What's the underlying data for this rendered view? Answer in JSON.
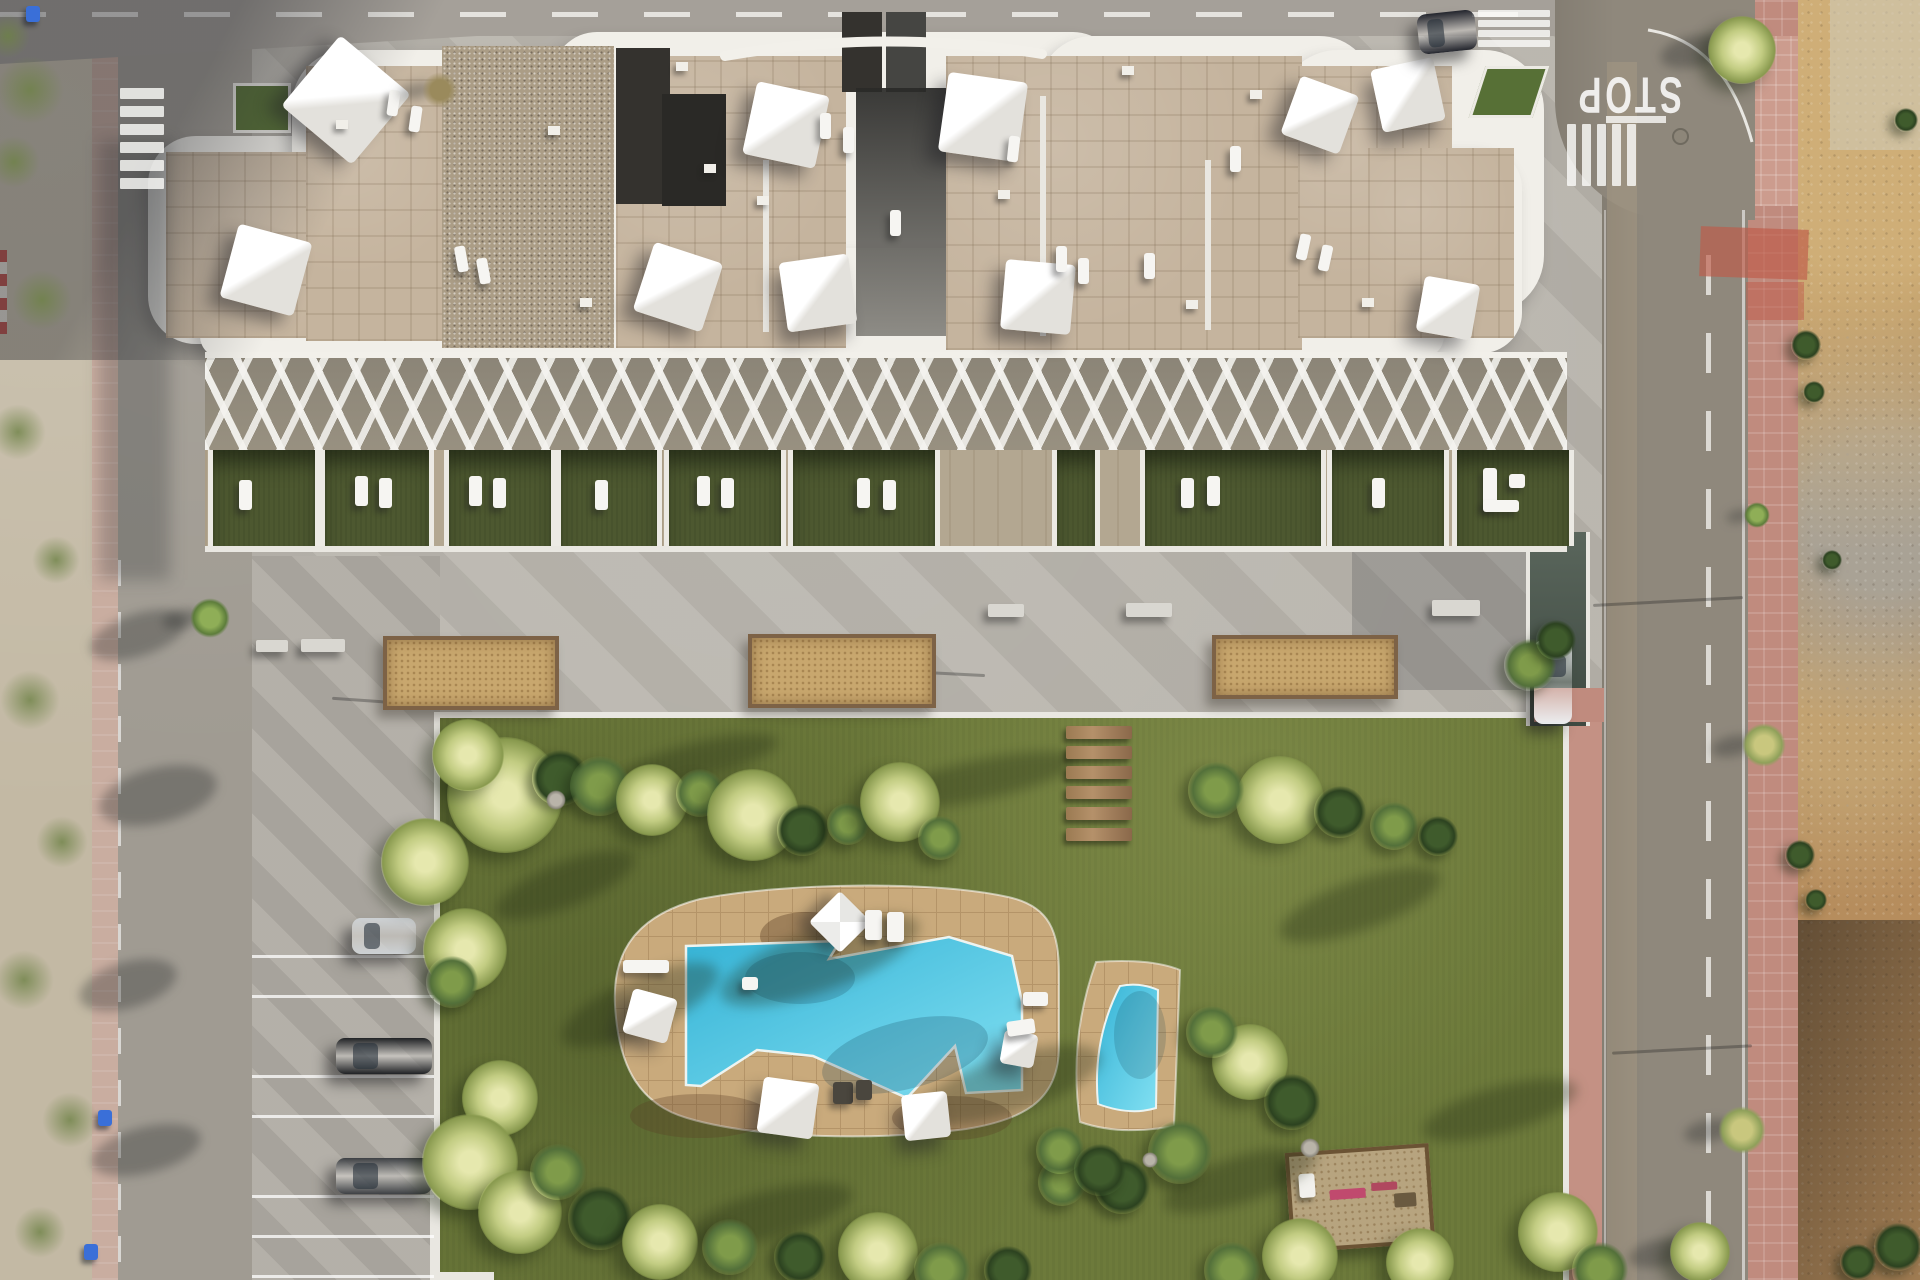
{
  "meta": {
    "description": "Aerial top-down 3D render of a white residential apartment complex with rooftop terraces and shade sails, communal lawn garden, free-form swimming pool with small plunge pool, concrete plaza with planters, street parking, roads with STOP marking and crosswalks, and an undeveloped dirt lot on the right"
  },
  "labels": {
    "stop": "STOP"
  },
  "palette": {
    "asphalt_left": "#a09b92",
    "asphalt_right": "#8f887c",
    "sidewalk_pink": "#c08b7e",
    "dirt": "#b68d5d",
    "lawn": "#6d7a3b",
    "concrete": "#b7b3ab",
    "pool_deck": "#c9aa7c",
    "pool_water": "#35b3d6",
    "stone_roof": "#c5b49e",
    "gravel_roof": "#ab9d86",
    "terrace_grass": "#4d5830",
    "building_white": "#f1efe9"
  },
  "building_sails": [
    [
      346,
      100,
      92,
      40
    ],
    [
      266,
      270,
      76,
      15
    ],
    [
      786,
      125,
      74,
      12
    ],
    [
      983,
      117,
      80,
      8
    ],
    [
      678,
      287,
      72,
      18
    ],
    [
      818,
      293,
      70,
      -8
    ],
    [
      1038,
      297,
      70,
      5
    ],
    [
      1320,
      115,
      62,
      20
    ],
    [
      1408,
      95,
      64,
      -12
    ],
    [
      1448,
      308,
      56,
      10
    ]
  ],
  "roof_loungers": [
    [
      388,
      90,
      8
    ],
    [
      410,
      106,
      8
    ],
    [
      820,
      113,
      0
    ],
    [
      843,
      127,
      0
    ],
    [
      1056,
      246,
      0
    ],
    [
      1078,
      258,
      0
    ],
    [
      1144,
      253,
      0
    ],
    [
      456,
      246,
      -10
    ],
    [
      478,
      258,
      -10
    ],
    [
      1298,
      234,
      12
    ],
    [
      1320,
      245,
      12
    ],
    [
      890,
      210,
      0
    ],
    [
      1230,
      146,
      0
    ],
    [
      1008,
      136,
      6
    ]
  ],
  "vents": [
    [
      548,
      126
    ],
    [
      676,
      62
    ],
    [
      704,
      164
    ],
    [
      757,
      196
    ],
    [
      1122,
      66
    ],
    [
      1250,
      90
    ],
    [
      580,
      298
    ],
    [
      1186,
      300
    ],
    [
      1362,
      298
    ],
    [
      998,
      190
    ],
    [
      336,
      120
    ]
  ],
  "terrace_cells": [
    {
      "x": 208,
      "w": 102,
      "l": [
        [
          26,
          30
        ]
      ]
    },
    {
      "x": 320,
      "w": 104,
      "l": [
        [
          30,
          26
        ],
        [
          54,
          28
        ]
      ]
    },
    {
      "x": 444,
      "w": 102,
      "l": [
        [
          20,
          26
        ],
        [
          44,
          28
        ]
      ]
    },
    {
      "x": 556,
      "w": 96,
      "l": [
        [
          34,
          30
        ]
      ]
    },
    {
      "x": 664,
      "w": 112,
      "l": [
        [
          28,
          26
        ],
        [
          52,
          28
        ]
      ]
    },
    {
      "x": 788,
      "w": 142,
      "l": [
        [
          64,
          28
        ],
        [
          90,
          30
        ]
      ]
    },
    {
      "x": 1052,
      "w": 38,
      "l": []
    },
    {
      "x": 1140,
      "w": 176,
      "l": [
        [
          36,
          28
        ],
        [
          62,
          26
        ]
      ]
    },
    {
      "x": 1327,
      "w": 112,
      "l": [
        [
          40,
          28
        ]
      ]
    },
    {
      "x": 1452,
      "w": 112,
      "sofa": true,
      "l": []
    }
  ],
  "planters": [
    [
      383,
      636,
      168,
      66
    ],
    [
      748,
      634,
      180,
      66
    ],
    [
      1212,
      635,
      178,
      56
    ]
  ],
  "benches": [
    [
      256,
      640,
      32,
      12
    ],
    [
      301,
      639,
      44,
      13
    ],
    [
      988,
      604,
      36,
      13
    ],
    [
      1126,
      603,
      46,
      14
    ],
    [
      1432,
      600,
      48,
      16
    ]
  ],
  "steps": {
    "x": 1066,
    "w": 66,
    "h": 13,
    "ys": [
      726,
      746,
      766,
      786,
      807,
      828
    ]
  },
  "parking": {
    "lines_y": [
      955,
      995,
      1075,
      1115,
      1195,
      1235,
      1275
    ],
    "cars": [
      {
        "x": 352,
        "y": 918,
        "w": 64,
        "h": 36,
        "c": "#cdd1d4"
      },
      {
        "x": 336,
        "y": 1038,
        "w": 96,
        "h": 36,
        "c": "#202225"
      },
      {
        "x": 336,
        "y": 1158,
        "w": 96,
        "h": 36,
        "c": "#3e4145"
      }
    ]
  },
  "street_cars": [
    {
      "x": 1418,
      "y": 12,
      "w": 58,
      "h": 40,
      "c": "#23252d",
      "rot": -6
    },
    {
      "x": 1534,
      "y": 640,
      "w": 38,
      "h": 84,
      "c": "#eceef0",
      "rot": 0
    }
  ],
  "crosswalks": [
    {
      "x": 120,
      "y": 88,
      "w": 44,
      "h": 11,
      "count": 6,
      "dx": 0,
      "dy": 18
    },
    {
      "x": 1567,
      "y": 124,
      "w": 9,
      "h": 62,
      "count": 5,
      "dx": 15,
      "dy": 0
    },
    {
      "x": 1478,
      "y": 10,
      "w": 72,
      "h": 7,
      "count": 4,
      "dx": 0,
      "dy": 10
    }
  ],
  "lawn_shadows": [
    [
      640,
      1005,
      170,
      54,
      -24
    ],
    [
      820,
      960,
      210,
      62,
      -20
    ],
    [
      1010,
      1085,
      190,
      58,
      -18
    ],
    [
      770,
      1215,
      170,
      48,
      -15
    ],
    [
      1360,
      905,
      170,
      50,
      -20
    ],
    [
      1500,
      1110,
      160,
      46,
      -16
    ],
    [
      565,
      885,
      150,
      44,
      -22
    ],
    [
      1240,
      1180,
      160,
      46,
      -18
    ],
    [
      980,
      780,
      200,
      40,
      -12
    ],
    [
      700,
      760,
      160,
      36,
      -14
    ]
  ],
  "road_shadows": [
    [
      138,
      635,
      100,
      42,
      -18
    ],
    [
      158,
      795,
      120,
      55,
      -14
    ],
    [
      128,
      985,
      100,
      46,
      -16
    ],
    [
      146,
      1150,
      112,
      46,
      -14
    ]
  ],
  "pole_shadows": [
    [
      905,
      672,
      80,
      3
    ],
    [
      1228,
      658,
      122,
      2
    ],
    [
      332,
      700,
      92,
      4
    ],
    [
      1352,
      524,
      82,
      2
    ],
    [
      1593,
      600,
      150,
      -3
    ],
    [
      1612,
      1048,
      140,
      -3
    ]
  ],
  "roadside_trees": [
    {
      "x": 1757,
      "y": 515,
      "r": 13,
      "k": "tree"
    },
    {
      "x": 1764,
      "y": 745,
      "r": 22,
      "k": "treeY"
    },
    {
      "x": 1742,
      "y": 1130,
      "r": 24,
      "k": "treeY"
    },
    {
      "x": 1742,
      "y": 50,
      "r": 34,
      "k": "palm"
    },
    {
      "x": 210,
      "y": 618,
      "r": 20,
      "k": "tree"
    },
    {
      "x": 440,
      "y": 90,
      "r": 18,
      "k": "dry"
    },
    {
      "x": 1700,
      "y": 1252,
      "r": 30,
      "k": "palm"
    }
  ],
  "dirt_shrubs": [
    [
      1806,
      345,
      15
    ],
    [
      1814,
      392,
      11
    ],
    [
      1800,
      855,
      15
    ],
    [
      1816,
      900,
      11
    ],
    [
      1898,
      1247,
      24
    ],
    [
      1858,
      1262,
      18
    ],
    [
      1906,
      120,
      12
    ],
    [
      1832,
      560,
      10
    ]
  ],
  "scrub_patches": [
    [
      30,
      90,
      34
    ],
    [
      14,
      162,
      26
    ],
    [
      42,
      300,
      30
    ],
    [
      18,
      432,
      28
    ],
    [
      56,
      560,
      24
    ],
    [
      30,
      700,
      30
    ],
    [
      62,
      842,
      26
    ],
    [
      24,
      980,
      30
    ],
    [
      70,
      1120,
      28
    ],
    [
      40,
      1232,
      26
    ],
    [
      8,
      36,
      22
    ]
  ],
  "bins": [
    [
      26,
      6
    ],
    [
      98,
      1110
    ],
    [
      84,
      1244
    ]
  ],
  "vegetation": [
    [
      505,
      795,
      58,
      "palm"
    ],
    [
      468,
      755,
      36,
      "palm"
    ],
    [
      560,
      778,
      28,
      "dark"
    ],
    [
      600,
      786,
      30,
      "bush"
    ],
    [
      652,
      800,
      36,
      "palm"
    ],
    [
      700,
      793,
      24,
      "bush"
    ],
    [
      753,
      815,
      46,
      "palm"
    ],
    [
      803,
      830,
      26,
      "dark"
    ],
    [
      848,
      824,
      21,
      "bush"
    ],
    [
      900,
      802,
      40,
      "palm"
    ],
    [
      940,
      838,
      22,
      "bush"
    ],
    [
      425,
      862,
      44,
      "palm"
    ],
    [
      465,
      950,
      42,
      "palm"
    ],
    [
      452,
      982,
      26,
      "bush"
    ],
    [
      500,
      1098,
      38,
      "palm"
    ],
    [
      470,
      1162,
      48,
      "palm"
    ],
    [
      520,
      1212,
      42,
      "palm"
    ],
    [
      558,
      1172,
      28,
      "bush"
    ],
    [
      600,
      1218,
      32,
      "dark"
    ],
    [
      660,
      1242,
      38,
      "palm"
    ],
    [
      730,
      1247,
      28,
      "bush"
    ],
    [
      800,
      1257,
      26,
      "dark"
    ],
    [
      878,
      1252,
      40,
      "palm"
    ],
    [
      942,
      1270,
      28,
      "bush"
    ],
    [
      1008,
      1270,
      24,
      "dark"
    ],
    [
      1250,
      1062,
      38,
      "palm"
    ],
    [
      1212,
      1032,
      26,
      "bush"
    ],
    [
      1292,
      1102,
      28,
      "dark"
    ],
    [
      1180,
      1152,
      32,
      "bush"
    ],
    [
      1122,
      1186,
      28,
      "dark"
    ],
    [
      1062,
      1182,
      24,
      "bush"
    ],
    [
      1300,
      1256,
      38,
      "palm"
    ],
    [
      1232,
      1270,
      28,
      "bush"
    ],
    [
      1420,
      1262,
      34,
      "palm"
    ],
    [
      1558,
      1232,
      40,
      "palm"
    ],
    [
      1600,
      1270,
      28,
      "bush"
    ],
    [
      1280,
      800,
      44,
      "palm"
    ],
    [
      1216,
      790,
      28,
      "bush"
    ],
    [
      1340,
      812,
      26,
      "dark"
    ],
    [
      1394,
      826,
      24,
      "bush"
    ],
    [
      1438,
      836,
      20,
      "dark"
    ],
    [
      1530,
      665,
      26,
      "bush"
    ],
    [
      1556,
      640,
      20,
      "dark"
    ],
    [
      1060,
      1150,
      24,
      "bush"
    ],
    [
      1100,
      1170,
      26,
      "dark"
    ],
    [
      556,
      800,
      10,
      "rock"
    ],
    [
      1310,
      1148,
      10,
      "rock"
    ],
    [
      1150,
      1160,
      8,
      "rock"
    ]
  ],
  "pool_furniture": {
    "umbrella": [
      840,
      922,
      44
    ],
    "sails": [
      [
        650,
        1016,
        46,
        15
      ],
      [
        788,
        1108,
        56,
        8
      ],
      [
        926,
        1116,
        46,
        -6
      ],
      [
        1019,
        1049,
        34,
        10
      ]
    ],
    "loungers": [
      [
        623,
        960,
        46,
        13,
        0,
        ""
      ],
      [
        865,
        910,
        17,
        30,
        0,
        ""
      ],
      [
        887,
        912,
        17,
        30,
        0,
        ""
      ],
      [
        1023,
        992,
        25,
        14,
        0,
        ""
      ],
      [
        1007,
        1020,
        28,
        15,
        -8,
        ""
      ],
      [
        833,
        1082,
        20,
        22,
        0,
        "dark"
      ],
      [
        856,
        1080,
        16,
        20,
        0,
        "dark"
      ]
    ],
    "table": [
      742,
      977,
      16,
      13
    ]
  },
  "playground": {
    "x": 1288,
    "y": 1148,
    "w": 136,
    "h": 92,
    "rot": -4
  }
}
